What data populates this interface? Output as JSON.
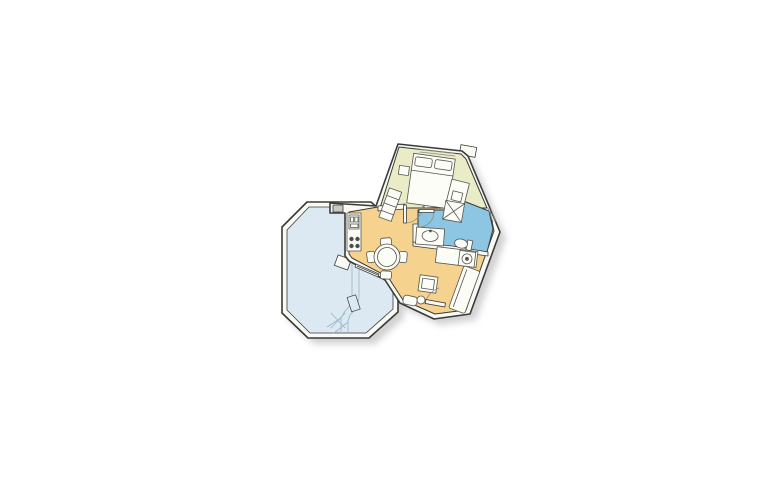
{
  "figure": {
    "type": "floor-plan",
    "subject": "small-apartment-with-octagonal-terrace",
    "rooms": [
      {
        "id": "terrace",
        "color_key": "terrace_floor"
      },
      {
        "id": "living-dining",
        "color_key": "living_floor"
      },
      {
        "id": "kitchen",
        "color_key": "living_floor"
      },
      {
        "id": "hallway",
        "color_key": "living_floor"
      },
      {
        "id": "bedroom",
        "color_key": "bedroom_floor"
      },
      {
        "id": "bathroom",
        "color_key": "bathroom_floor"
      }
    ],
    "furniture": [
      "double-bed",
      "pillows",
      "nightstand",
      "dresser",
      "shelf-unit",
      "shower",
      "washbasin",
      "toilet",
      "washing-machine",
      "utility-counter",
      "kitchen-counter",
      "kitchen-sink",
      "stove-burners",
      "dining-table",
      "dining-chairs",
      "sofa",
      "coffee-table",
      "entrance-cabinet",
      "door-leaves"
    ]
  },
  "colors": {
    "background": "#ffffff",
    "outline": "#3a3a3a",
    "wall_fill": "#fafaf4",
    "terrace_floor": "#dce9f2",
    "terrace_line": "#9ab4c6",
    "living_floor": "#f5d28e",
    "bedroom_floor": "#e9ecc6",
    "bathroom_floor": "#8cc6e2",
    "furniture_fill": "#fdfdf8",
    "furniture_line": "#55554f",
    "detail_line": "#8a8a82",
    "column_fill": "#c9c9c0",
    "burner_fill": "#4a4a46",
    "shadow": "#9a9a9a"
  }
}
